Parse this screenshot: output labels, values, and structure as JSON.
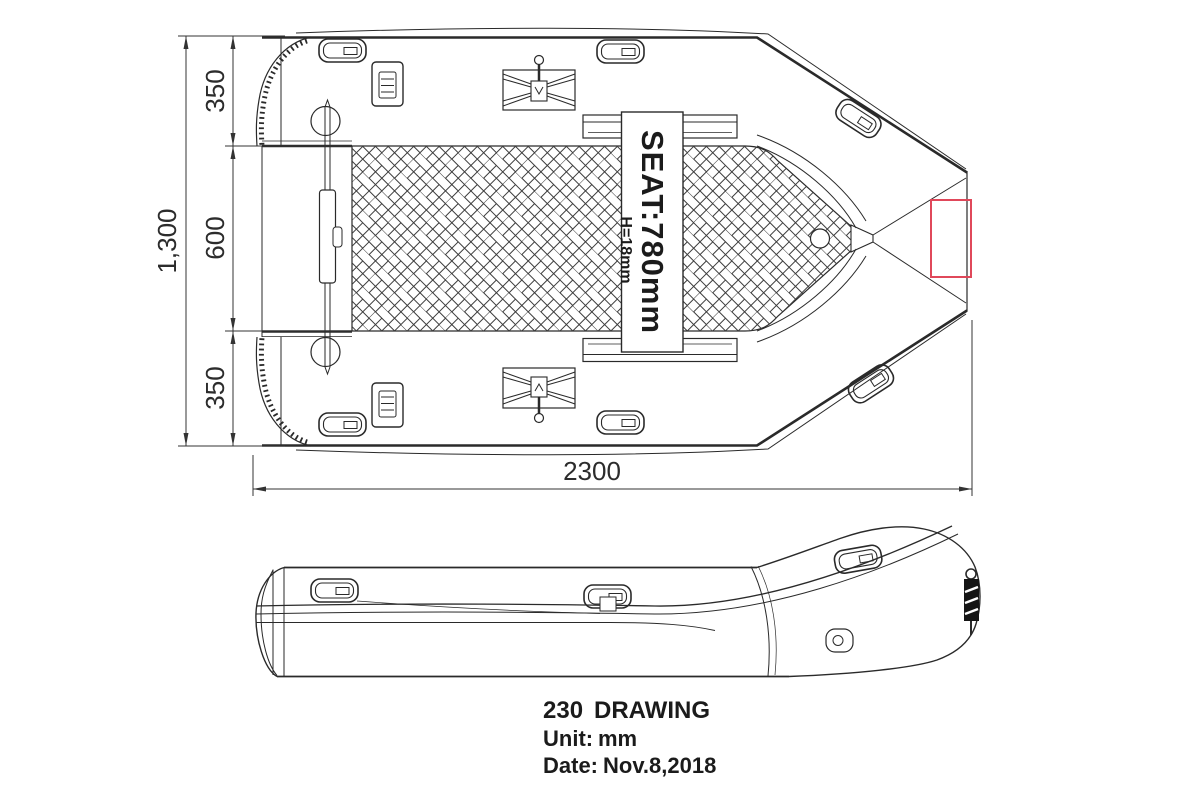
{
  "drawing": {
    "model": "230",
    "title_word": "DRAWING",
    "unit_label": "Unit:",
    "unit_value": "mm",
    "date_label": "Date:",
    "date_value": "Nov.8,2018"
  },
  "dimensions": {
    "overall_length": "2300",
    "overall_beam": "1,300",
    "stern_tube": "350",
    "cockpit_width": "600",
    "bow_tube": "350"
  },
  "seat": {
    "label": "SEAT:780mm",
    "height": "H=18mm"
  },
  "colors": {
    "line": "#2a2a2a",
    "accent_red": "#e0485a",
    "background": "#ffffff"
  }
}
